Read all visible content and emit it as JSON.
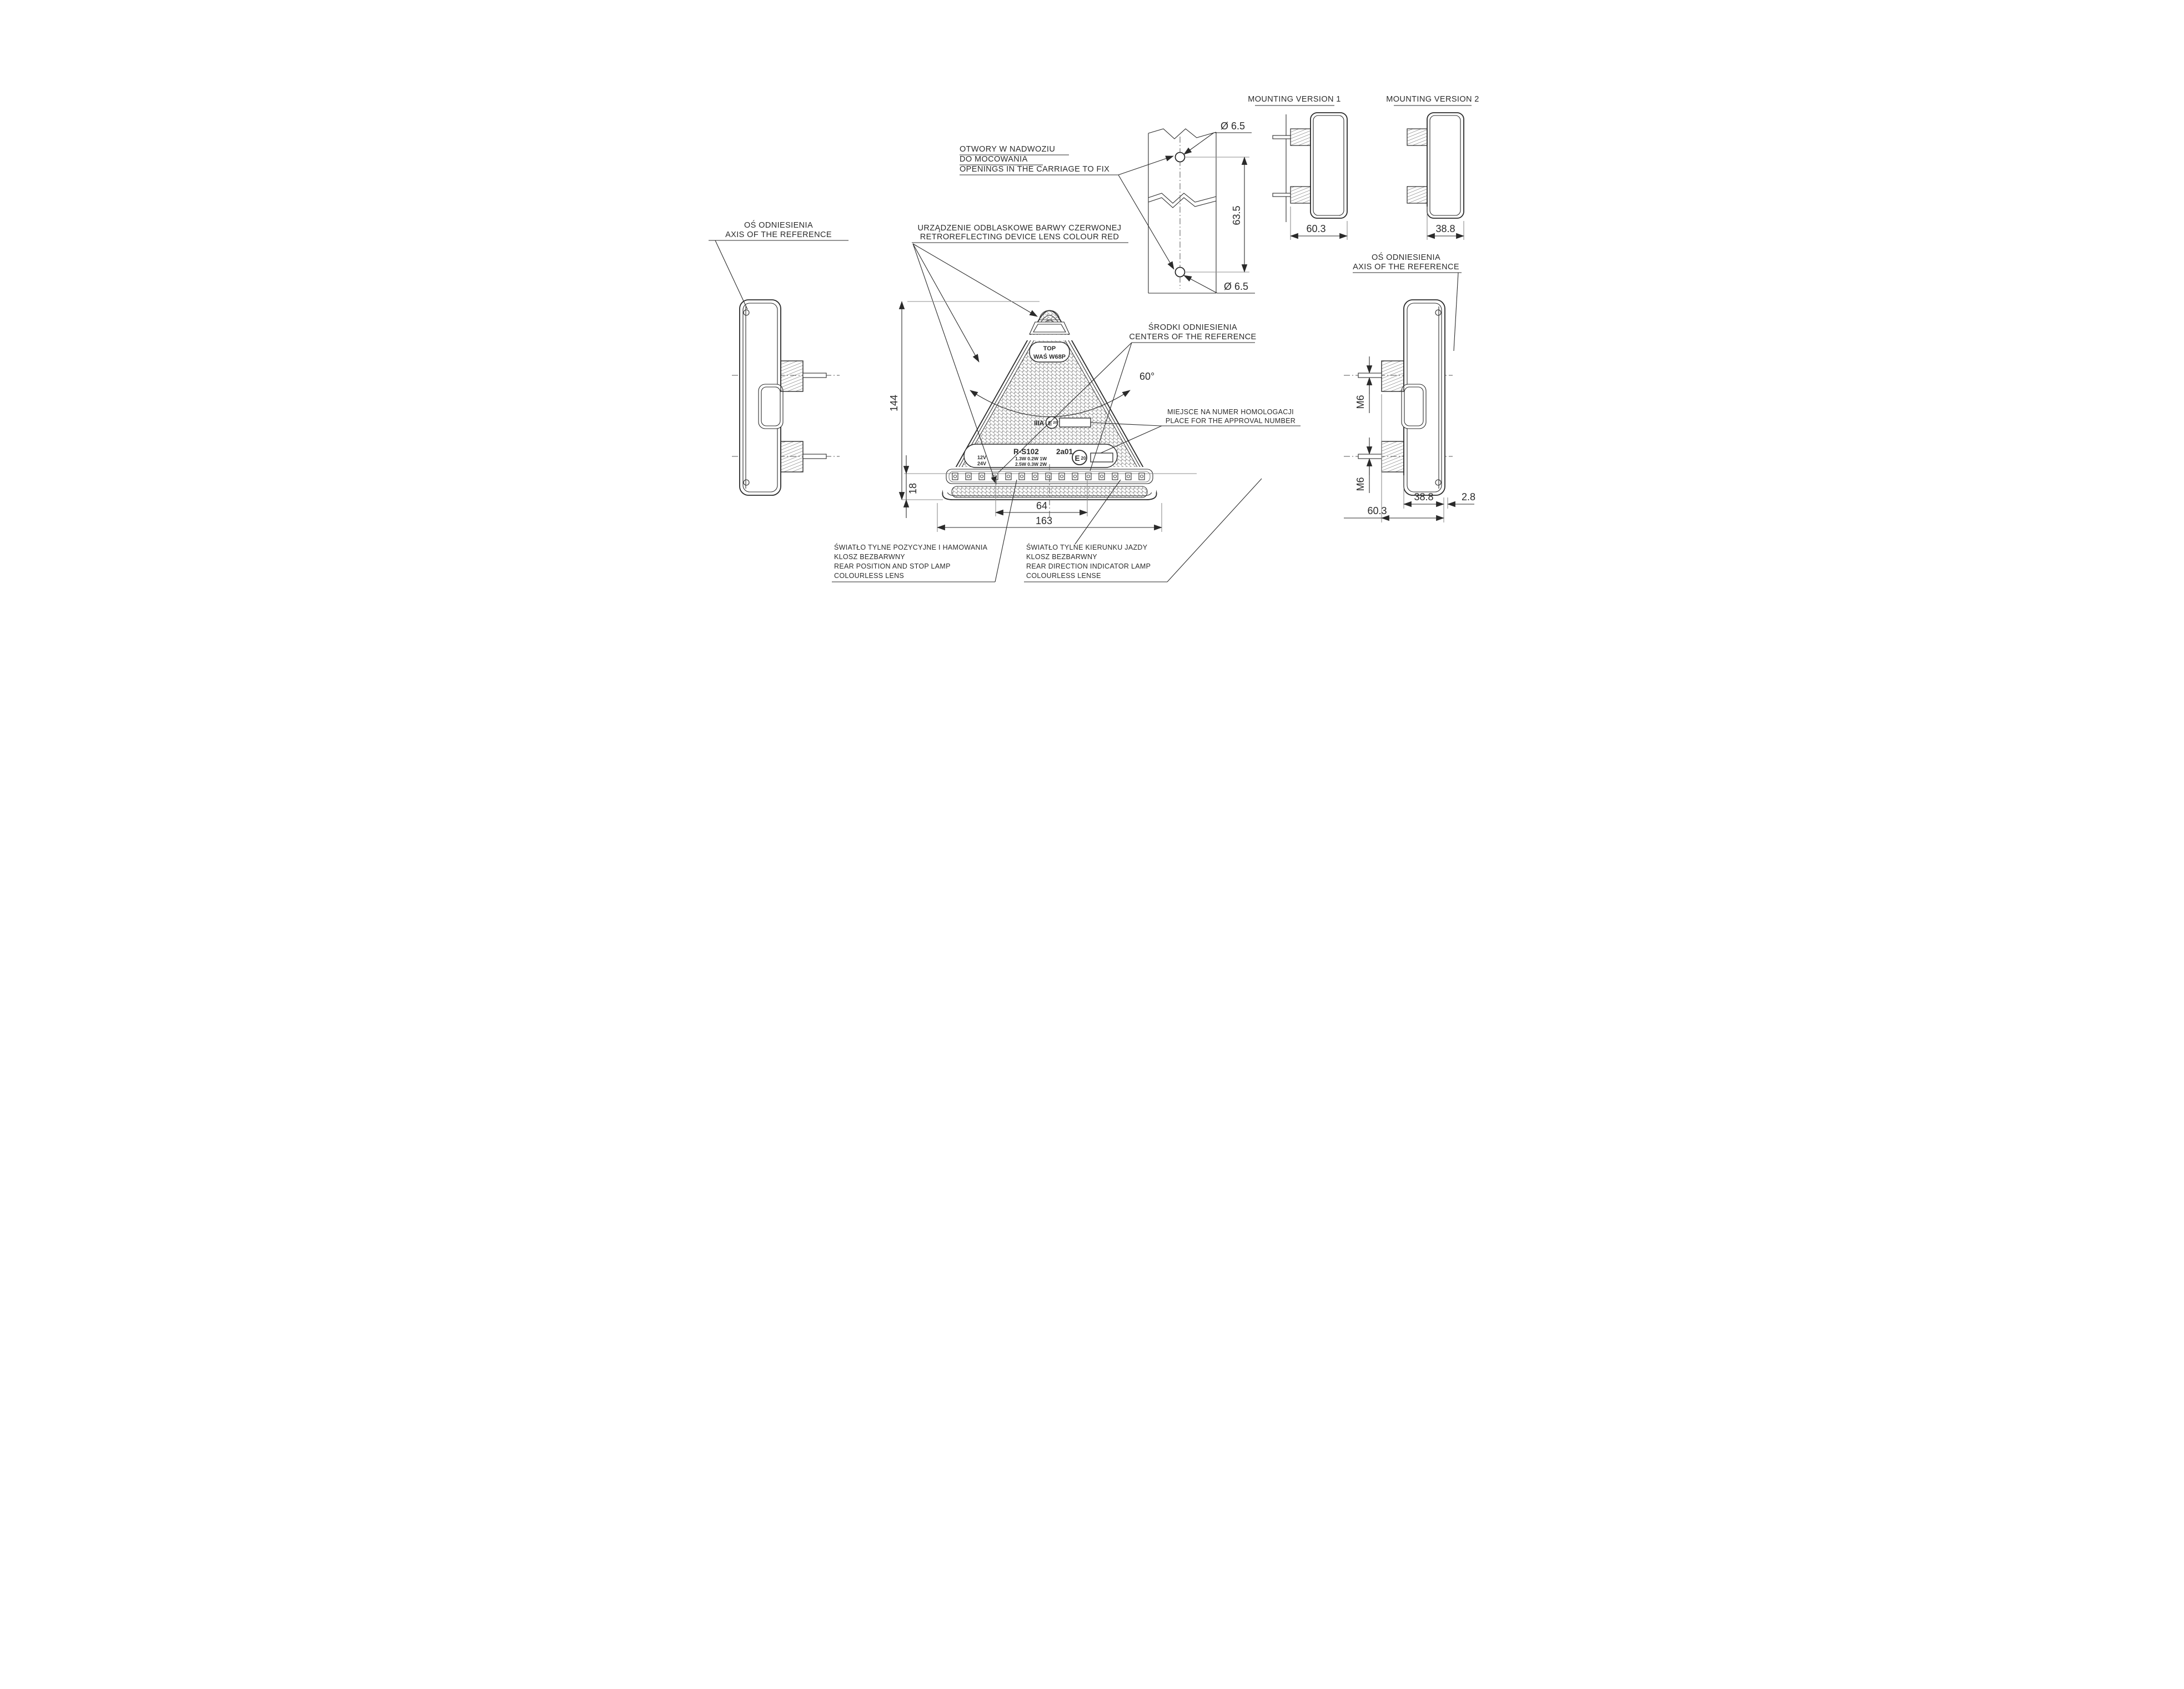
{
  "labels": {
    "axis_reference": {
      "pl": "OŚ ODNIESIENIA",
      "en": "AXIS OF THE REFERENCE"
    },
    "openings": {
      "pl1": "OTWORY W NADWOZIU",
      "pl2": "DO MOCOWANIA",
      "en": "OPENINGS IN THE CARRIAGE TO FIX"
    },
    "retroreflector": {
      "pl": "URZĄDZENIE ODBLASKOWE BARWY CZERWONEJ",
      "en": "RETROREFLECTING DEVICE LENS COLOUR RED"
    },
    "centers": {
      "pl": "ŚRODKI ODNIESIENIA",
      "en": "CENTERS OF THE REFERENCE"
    },
    "approval": {
      "pl": "MIEJSCE NA NUMER HOMOLOGACJI",
      "en": "PLACE FOR THE APPROVAL NUMBER"
    },
    "stop_lamp": {
      "pl1": "ŚWIATŁO TYLNE POZYCYJNE I HAMOWANIA",
      "pl2": "KLOSZ BEZBARWNY",
      "en1": "REAR POSITION AND STOP LAMP",
      "en2": "COLOURLESS LENS"
    },
    "indicator_lamp": {
      "pl1": "ŚWIATŁO TYLNE KIERUNKU JAZDY",
      "pl2": "KLOSZ BEZBARWNY",
      "en1": "REAR DIRECTION INDICATOR LAMP",
      "en2": "COLOURLESS LENSE"
    },
    "mounting_version_1": "MOUNTING VERSION 1",
    "mounting_version_2": "MOUNTING VERSION 2"
  },
  "dimensions": {
    "height": "144",
    "base_width": "163",
    "led_spacing": "64",
    "bottom_offset": "18",
    "hole_diameter": "Ø 6.5",
    "hole_spacing": "63.5",
    "depth_total": "60.3",
    "depth_body": "38.8",
    "lens_lip": "2.8",
    "thread": "M6",
    "apex_angle": "60°"
  },
  "markings": {
    "top": "TOP",
    "model": "WAŚ W68P",
    "photometric_class": "IIIA",
    "e_mark_letter": "E",
    "e_mark_number": "20",
    "type": "R-S102",
    "approval_code": "2a01",
    "voltage_1": "12V",
    "voltage_2": "24V",
    "power_row_1": "1.3W 0.2W   1W",
    "power_row_2": "2.5W 0.3W   2W"
  },
  "colors": {
    "line": "#2a2a2a",
    "aux": "#8c8c8c"
  }
}
